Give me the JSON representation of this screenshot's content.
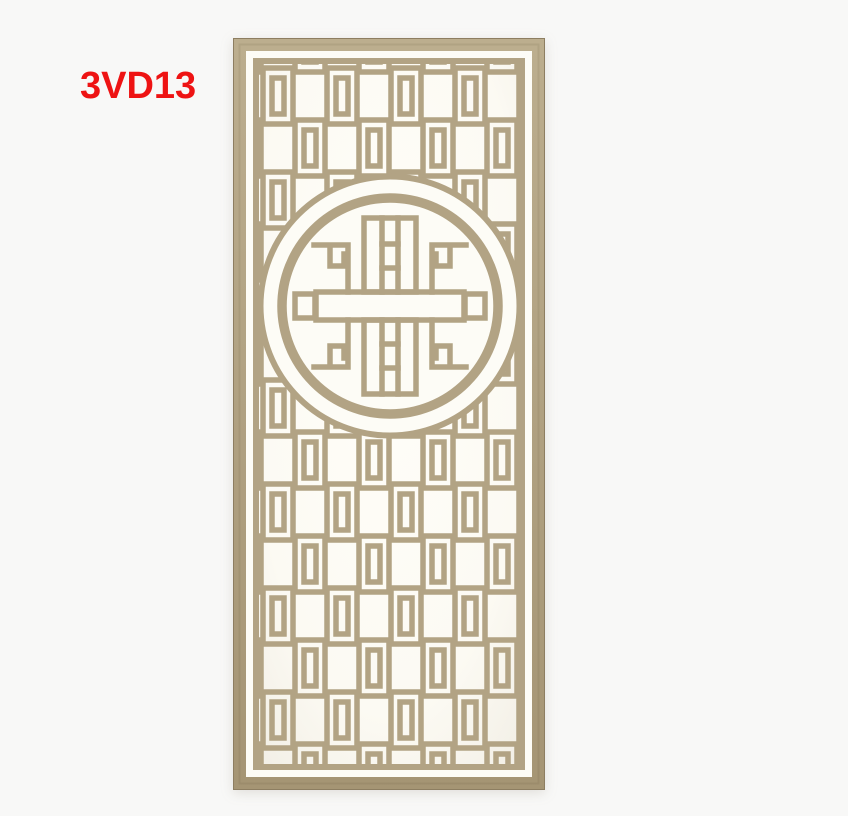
{
  "colors": {
    "background": "#f8f8f7",
    "label_red": "#ee1313",
    "wood": "#b2a384",
    "wood_dark": "#a09070",
    "wood_deep": "#8d7e61",
    "wood_light": "#c6b899",
    "opening": "#fdfcf6"
  },
  "label": {
    "text": "3VD13"
  },
  "panel": {
    "description": "Tan carved wooden Chinese lattice screen panel, tall rectangle with rectangular fretwork grid and a circular shou-symbol medallion in the upper middle, photographed on a plain light background"
  }
}
